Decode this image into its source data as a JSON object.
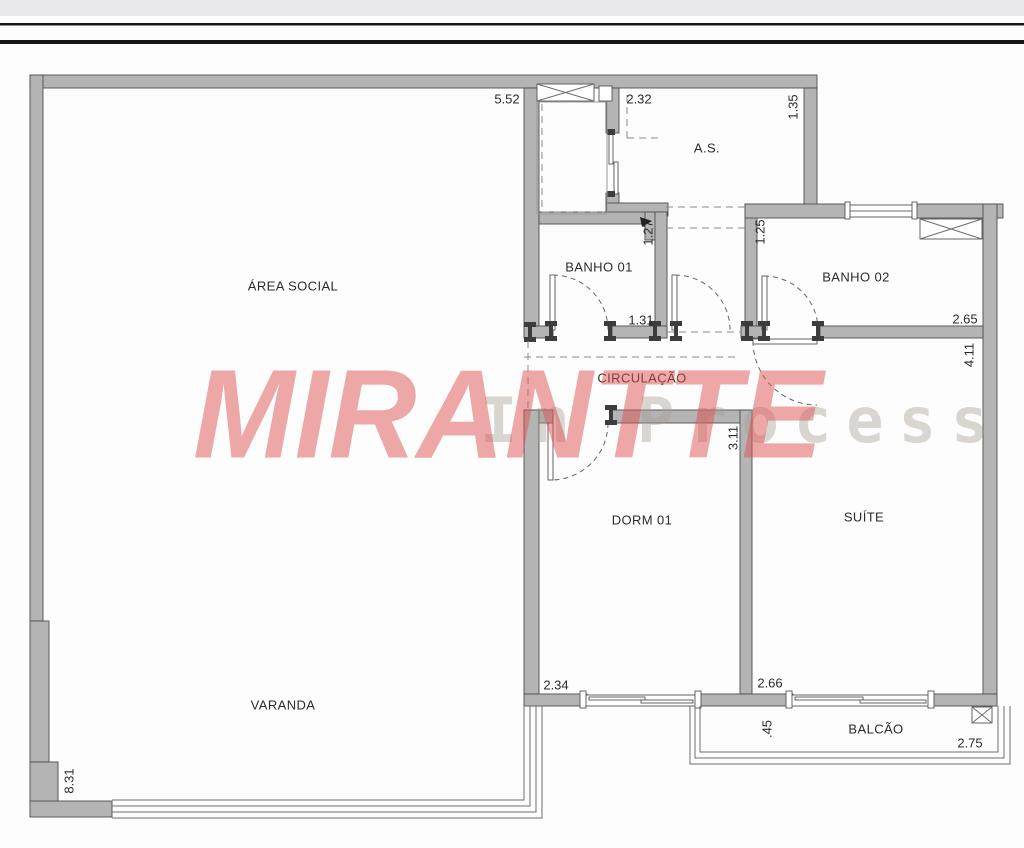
{
  "header": {
    "band_color": "#e9e9ec",
    "rule_color": "#161616"
  },
  "watermark": {
    "title": "MIRANTTE",
    "subtitle": "In Process",
    "title_color": "rgba(224,82,82,0.50)",
    "subtitle_color": "rgba(168,160,150,0.42)"
  },
  "plan": {
    "wall_color": "#b4b4b4",
    "wall_edge_color": "#4d4d4d",
    "rooms": {
      "area_social": {
        "label": "ÁREA SOCIAL"
      },
      "as": {
        "label": "A.S."
      },
      "banho_01": {
        "label": "BANHO 01"
      },
      "banho_02": {
        "label": "BANHO 02"
      },
      "circulacao": {
        "label": "CIRCULAÇÃO"
      },
      "dorm_01": {
        "label": "DORM 01"
      },
      "suite": {
        "label": "SUÍTE"
      },
      "varanda": {
        "label": "VARANDA"
      },
      "balcao": {
        "label": "BALCÃO"
      }
    },
    "dimensions": {
      "d552": {
        "label": "5.52"
      },
      "d232": {
        "label": "2.32"
      },
      "d135": {
        "label": "1.35"
      },
      "d127": {
        "label": "1.27"
      },
      "d125": {
        "label": "1.25"
      },
      "d131": {
        "label": "1.31"
      },
      "d265": {
        "label": "2.65"
      },
      "d411": {
        "label": "4.11"
      },
      "d311": {
        "label": "3.11"
      },
      "d234": {
        "label": "2.34"
      },
      "d266": {
        "label": "2.66"
      },
      "d045": {
        "label": ".45"
      },
      "d275": {
        "label": "2.75"
      },
      "d831": {
        "label": "8.31"
      }
    }
  }
}
